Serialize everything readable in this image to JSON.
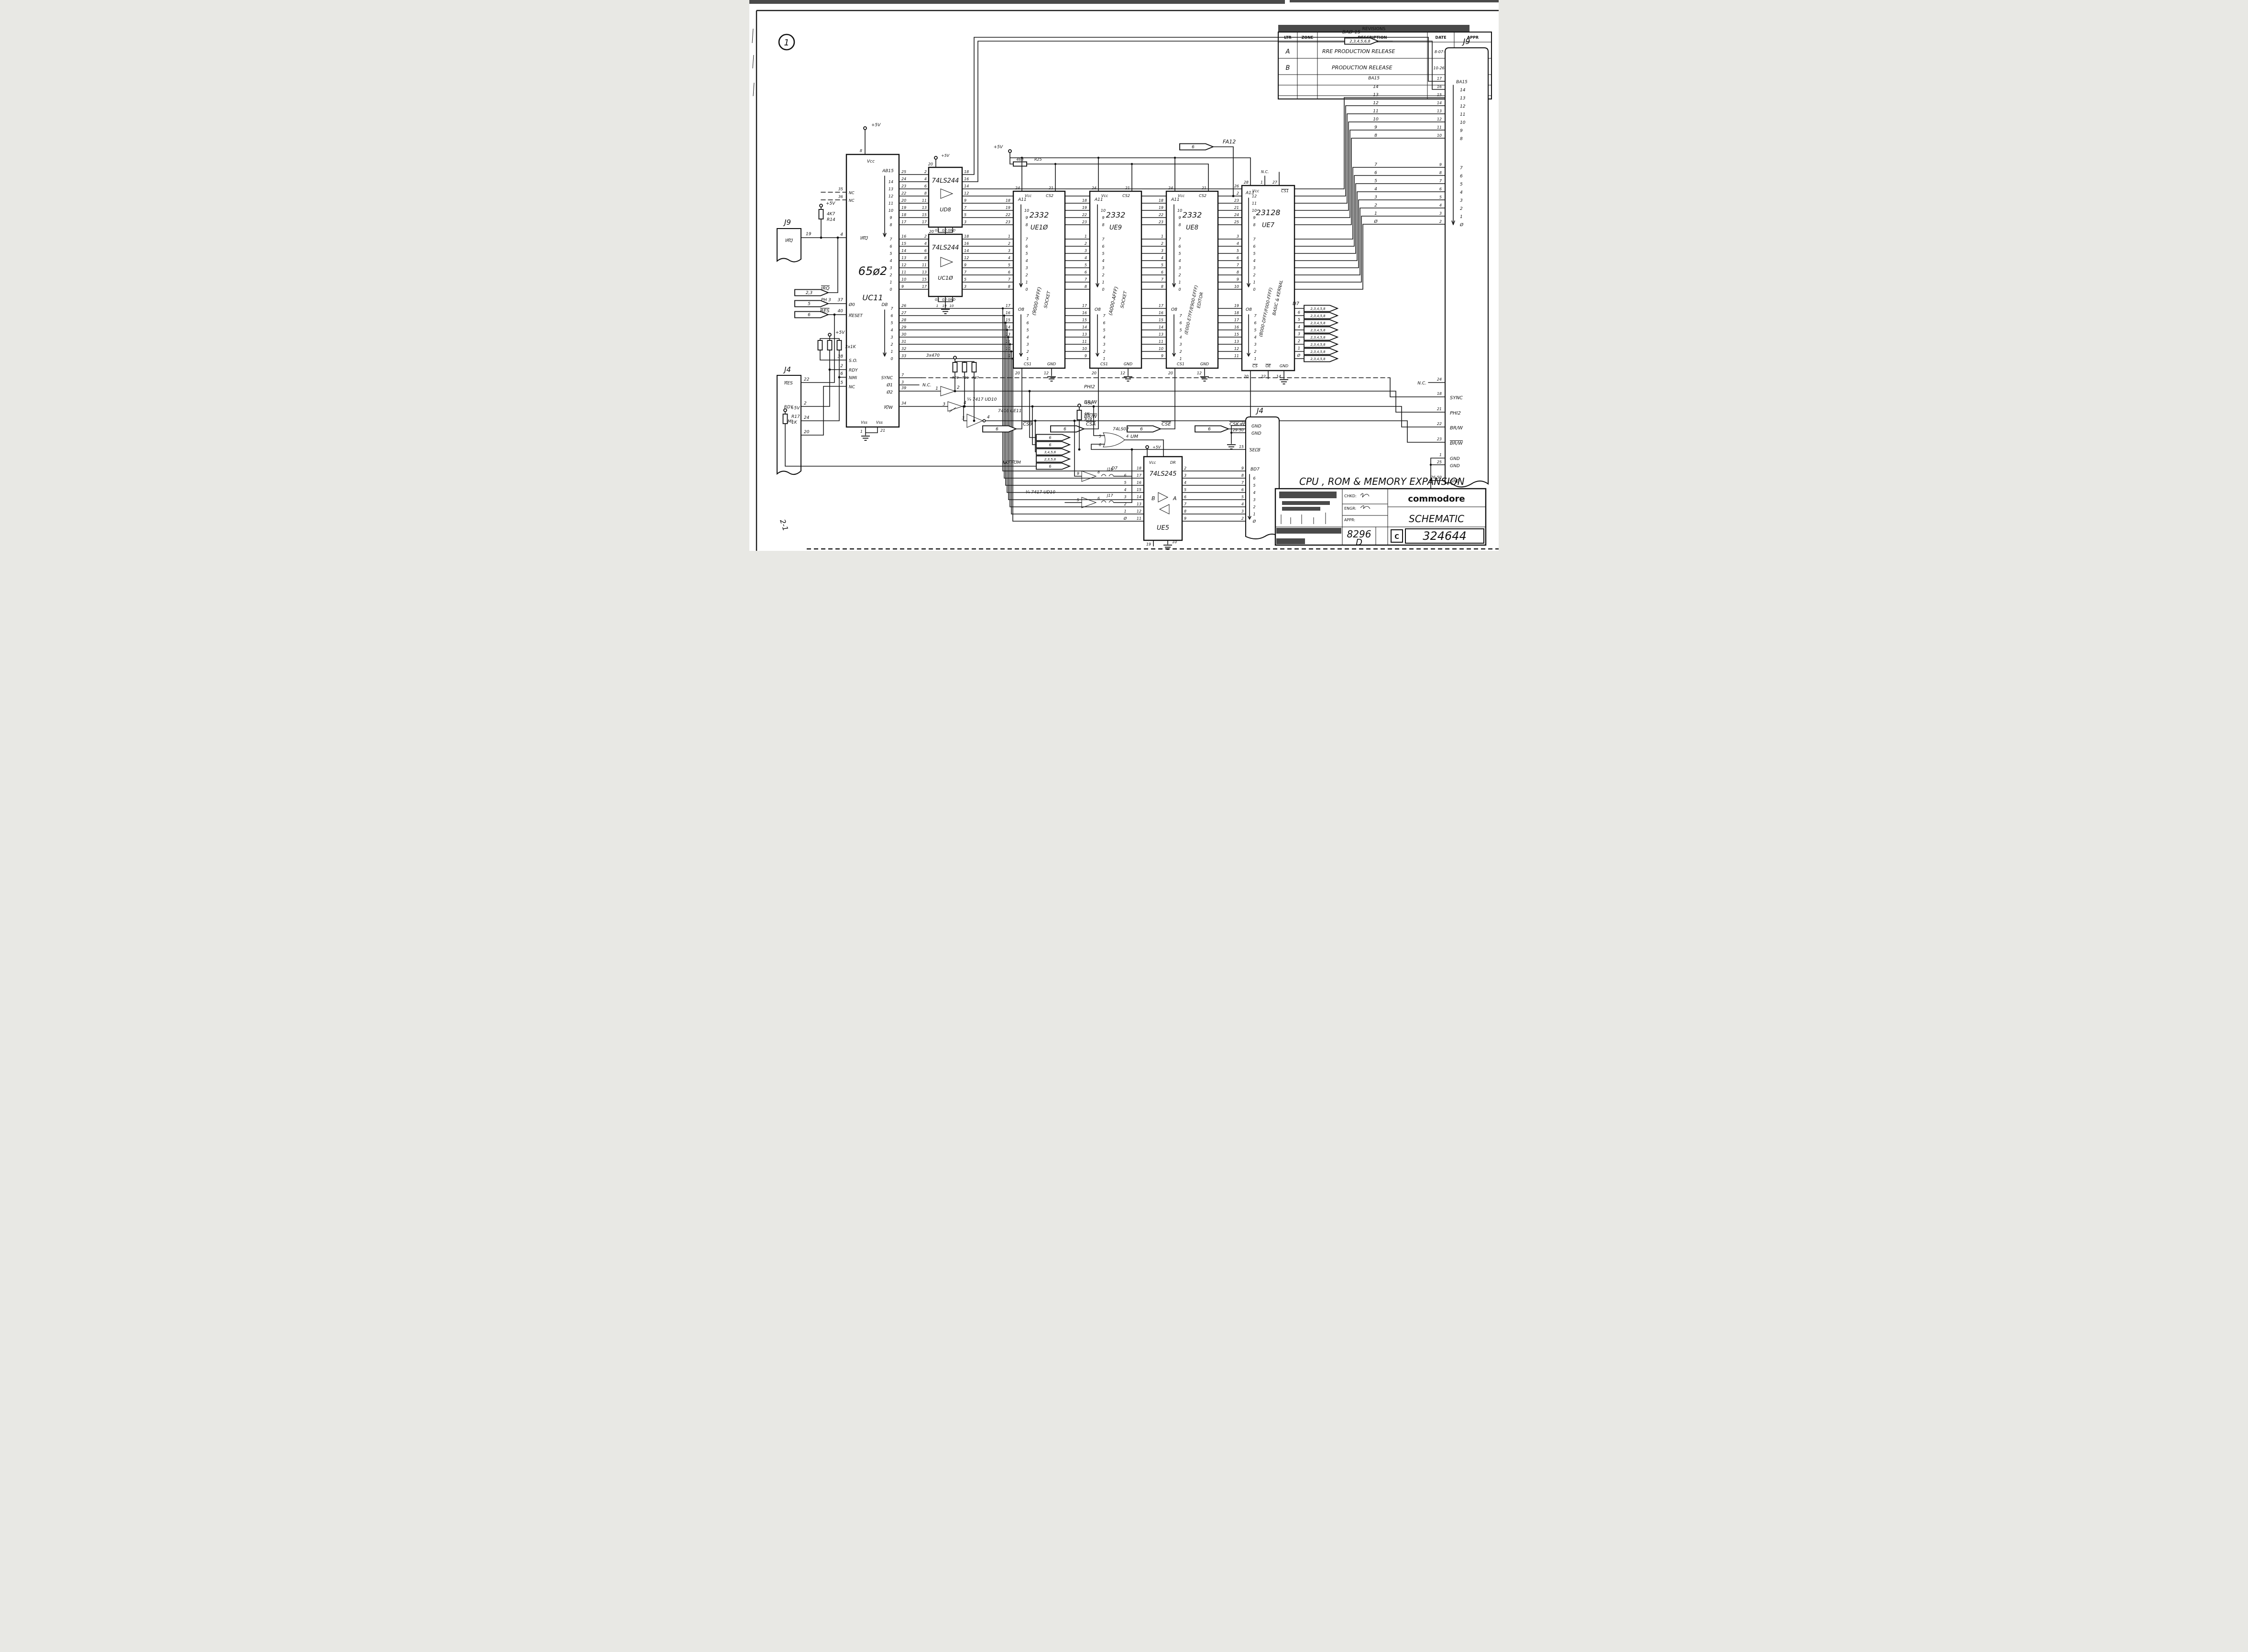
{
  "page": {
    "circle": "1",
    "side": "2-1"
  },
  "revisions": {
    "banner": "REVISIONS",
    "headers": [
      "LTR",
      "ZONE",
      "DESCRIPTION",
      "DATE",
      "APPR"
    ],
    "rows": [
      {
        "ltr": "A",
        "zone": "",
        "desc": "RRE PRODUCTION RELEASE",
        "date": "8-07-8",
        "appr": "SL"
      },
      {
        "ltr": "B",
        "zone": "",
        "desc": "PRODUCTION RELEASE",
        "date": "10-26-8",
        "appr": "SQ"
      }
    ]
  },
  "title_block": {
    "sheet_title": "CPU , ROM & MEMORY EXPANSION",
    "brand": "commodore",
    "doc": "SCHEMATIC",
    "chkd": "CHKD:",
    "engr": "ENGR:",
    "appr": "APPR:",
    "model": "8296",
    "size": "D",
    "class": "C",
    "number": "324644"
  },
  "power": {
    "v5": "+5V"
  },
  "cpu": {
    "part": "65ø2",
    "ref": "UC11",
    "vcc": "Vcc",
    "vcc_pin": "8",
    "nc_top_pins": [
      "35",
      "36"
    ],
    "nc": "NC",
    "irq": {
      "label": "IRQ",
      "pin": "4"
    },
    "phi0": {
      "label": "Ø0",
      "pin": "37"
    },
    "reset": {
      "label": "RESET",
      "pin": "40"
    },
    "so": {
      "label": "S.O.",
      "pin": "38"
    },
    "rdy": {
      "label": "RDY",
      "pin": "2"
    },
    "nmi": {
      "label": "NMI",
      "pin": "6"
    },
    "nc5": {
      "label": "NC",
      "pin": "5"
    },
    "vss": {
      "label": "Vss",
      "pin1": "1",
      "pin2": "21"
    },
    "ab_label": "AB15",
    "ab_hi_bits": [
      "14",
      "13",
      "12",
      "11",
      "10",
      "9",
      "8"
    ],
    "ab_hi_pins": [
      "25",
      "24",
      "23",
      "22",
      "20",
      "19",
      "18",
      "17"
    ],
    "ab_lo_bits": [
      "7",
      "6",
      "5",
      "4",
      "3",
      "2",
      "1",
      "0"
    ],
    "ab_lo_pins": [
      "16",
      "15",
      "14",
      "13",
      "12",
      "11",
      "10",
      "9"
    ],
    "db_label": "DB",
    "db_bits": [
      "7",
      "6",
      "5",
      "4",
      "3",
      "2",
      "1",
      "0"
    ],
    "db_pins": [
      "26",
      "27",
      "28",
      "29",
      "30",
      "31",
      "32",
      "33"
    ],
    "sync": {
      "label": "SYNC",
      "pin": "7"
    },
    "phi1": {
      "label": "Ø1",
      "pin": "3",
      "note": "N.C."
    },
    "phi2": {
      "label": "Ø2",
      "pin": "39"
    },
    "rw": {
      "label": "R/W",
      "pin": "34"
    }
  },
  "j9_left": {
    "ref": "J9",
    "net": "IRQ",
    "pin": "19"
  },
  "r14": {
    "value": "4K7",
    "ref": "R14"
  },
  "flags_left": [
    {
      "tag": "2,3",
      "net": "IRQ"
    },
    {
      "tag": "5",
      "net": "PH 3"
    },
    {
      "tag": "6",
      "net": "RES"
    }
  ],
  "j4_left": {
    "ref": "J4",
    "rows": [
      {
        "label": "RES",
        "pin": "22"
      },
      {
        "label": "RDY",
        "pin": "2"
      },
      {
        "label": "NMI",
        "pin": "24"
      },
      {
        "label": "",
        "pin": "20"
      }
    ]
  },
  "rp_1k": {
    "value": "3x1K"
  },
  "r17": {
    "ref": "R17",
    "value": "1K"
  },
  "buffers": {
    "ud8": {
      "part": "74LS244",
      "ref": "UD8",
      "vcc": "Vcc",
      "vcc_pin": "20",
      "in_pins": [
        "2",
        "4",
        "6",
        "8",
        "11",
        "13",
        "15",
        "17"
      ],
      "out_pins": [
        "18",
        "16",
        "14",
        "12",
        "9",
        "7",
        "5",
        "3"
      ],
      "g_labels": [
        "G1",
        "G2",
        "GND"
      ],
      "g_pins": [
        "1",
        "19",
        "10"
      ]
    },
    "uc10": {
      "part": "74LS244",
      "ref": "UC1Ø",
      "vcc": "Vcc",
      "vcc_pin": "20",
      "in_pins": [
        "2",
        "4",
        "6",
        "8",
        "11",
        "13",
        "15",
        "17"
      ],
      "out_pins": [
        "18",
        "16",
        "14",
        "12",
        "9",
        "7",
        "5",
        "3"
      ],
      "g_labels": [
        "G1",
        "G2",
        "GND"
      ],
      "g_pins": [
        "1",
        "19",
        "10"
      ]
    }
  },
  "r25": {
    "value": "468",
    "ref": "R25"
  },
  "rom_common": {
    "a_label": "A11",
    "a_hi_bits": [
      "10",
      "9",
      "8"
    ],
    "a_lo_bits": [
      "7",
      "6",
      "5",
      "4",
      "3",
      "2",
      "1",
      "0"
    ],
    "hi_pins": [
      "18",
      "19",
      "22",
      "23"
    ],
    "lo_pins": [
      "1",
      "2",
      "3",
      "4",
      "5",
      "6",
      "7",
      "8"
    ],
    "o_label": "O8",
    "o_bits": [
      "7",
      "6",
      "5",
      "4",
      "3",
      "2",
      "1"
    ],
    "out_pins": [
      "17",
      "16",
      "15",
      "14",
      "13",
      "11",
      "10",
      "9"
    ],
    "vcc": "Vcc",
    "vcc_pin": "24",
    "cs2": "CS2",
    "cs2_pin": "21",
    "cs1": "CS1",
    "cs1_pin": "20",
    "gnd": "GND",
    "gnd_pin": "12"
  },
  "roms": [
    {
      "part": "2332",
      "ref": "UE1Ø",
      "range": "(9000-9FFF)",
      "use": "SOCKET"
    },
    {
      "part": "2332",
      "ref": "UE9",
      "range": "(A000-AFFF)",
      "use": "SOCKET"
    },
    {
      "part": "2332",
      "ref": "UE8",
      "range": "(E000-E7FF/E900-EFFF)",
      "use": "EDITOR"
    }
  ],
  "ue7": {
    "part": "23128",
    "ref": "UE7",
    "range": "(B000-DFFF/F000-FFFF)",
    "use": "BASIC & KERNAL",
    "a_label": "A13",
    "hi_bits": [
      "12",
      "11",
      "10",
      "9",
      "8"
    ],
    "hi_pins": [
      "26",
      "2",
      "23",
      "21",
      "24",
      "25"
    ],
    "lo_bits": [
      "7",
      "6",
      "5",
      "4",
      "3",
      "2",
      "1",
      "0"
    ],
    "lo_pins": [
      "3",
      "4",
      "5",
      "6",
      "7",
      "8",
      "9",
      "10"
    ],
    "o_label": "O8",
    "o_bits": [
      "7",
      "6",
      "5",
      "4",
      "3",
      "2",
      "1"
    ],
    "out_pins": [
      "19",
      "18",
      "17",
      "16",
      "15",
      "13",
      "12",
      "11"
    ],
    "vcc": "Vcc",
    "vcc_pin": "28",
    "nc": "N.C.",
    "nc_pin": "1",
    "cs1": "CS1",
    "cs1_pin": "27",
    "cs": "CS",
    "cs_pin": "20",
    "oe": "OE",
    "oe_pin": "22",
    "gnd": "GND",
    "gnd_pin": "14"
  },
  "fa12": {
    "tag": "6",
    "net": "FA12"
  },
  "ba_flag": {
    "tag": "2,3,4,5,6,8",
    "net": "BAØ-15"
  },
  "cs_flags": [
    {
      "tag": "6",
      "net": "CS9"
    },
    {
      "tag": "6",
      "net": "CSA"
    },
    {
      "tag": "6",
      "net": "CSE"
    },
    {
      "tag": "6",
      "net": "CSK+B"
    }
  ],
  "misc_flags": {
    "tags": [
      "6",
      "6",
      "3,4,5,6",
      "2,3,5,6",
      "6"
    ],
    "no_rom": "NO ROM"
  },
  "gates": {
    "ud10a": {
      "label": "¼ 7417 UD10",
      "g1_in": "1",
      "g1_out": "2",
      "g2_in": "3",
      "g2_out": "4"
    },
    "ue11": {
      "label": "7406 UE11",
      "in": "3",
      "out": "4"
    },
    "ud10b": {
      "label": "¼ 7417 UD10",
      "g1_in": "9",
      "g1_out": "8",
      "g2_in": "5",
      "g2_out": "6",
      "j1": "J16",
      "j2": "J17"
    },
    "um": {
      "part": "74LS02",
      "ref": "UM",
      "in1": "5",
      "in2": "6",
      "out": "4"
    }
  },
  "r470": {
    "value": "3x470",
    "refs": [
      "R20",
      "R21",
      "R27"
    ]
  },
  "r24": {
    "value": "1K",
    "ref": "R24"
  },
  "nets": {
    "phi2": "PHI2",
    "brw": "BR/W",
    "brwn": "BR/W",
    "sync": "SYNC"
  },
  "d_bus": {
    "label": "D7",
    "bits": [
      "6",
      "5",
      "4",
      "3",
      "2",
      "1",
      "Ø"
    ],
    "flag_tag": "2,3,4,5,8"
  },
  "ue5": {
    "part": "74LS245",
    "ref": "UE5",
    "b": "B",
    "a": "A",
    "dr": "DR",
    "vcc": "Vcc",
    "left_label": "D7",
    "left_bits": [
      "6",
      "5",
      "4",
      "3",
      "2",
      "1",
      "Ø"
    ],
    "left_pins": [
      "18",
      "17",
      "16",
      "15",
      "14",
      "13",
      "12",
      "11"
    ],
    "right_pins": [
      "2",
      "3",
      "4",
      "5",
      "6",
      "7",
      "8",
      "9"
    ],
    "en_pin": "19",
    "gnd_pin": "10"
  },
  "j4_right": {
    "ref": "J4",
    "gnd1_pin": "1",
    "gnd1": "GND",
    "gnd2_pin": "29-50",
    "gnd2": "GND",
    "sel_pin": "15",
    "sel": "SELB",
    "bd_label": "BD7",
    "bd_bits": [
      "6",
      "5",
      "4",
      "3",
      "2",
      "1",
      "Ø"
    ],
    "bd_pins": [
      "9",
      "8",
      "7",
      "6",
      "5",
      "4",
      "3",
      "2"
    ]
  },
  "j9_right": {
    "ref": "J9",
    "ba_label": "BA15",
    "hi_bits": [
      "14",
      "13",
      "12",
      "11",
      "10",
      "9",
      "8"
    ],
    "hi_pins": [
      "17",
      "16",
      "15",
      "14",
      "13",
      "12",
      "11",
      "10"
    ],
    "lo_bits": [
      "7",
      "6",
      "5",
      "4",
      "3",
      "2",
      "1",
      "Ø"
    ],
    "lo_pins": [
      "9",
      "8",
      "7",
      "6",
      "5",
      "4",
      "3",
      "2"
    ],
    "inner_hi": [
      "BA15",
      "14",
      "13",
      "12",
      "11",
      "10",
      "9",
      "8"
    ],
    "inner_lo": [
      "7",
      "6",
      "5",
      "4",
      "3",
      "2",
      "1",
      "Ø"
    ],
    "nc": {
      "pin": "24",
      "label": "N.C."
    },
    "signals": [
      {
        "pin": "18",
        "label": "SYNC"
      },
      {
        "pin": "21",
        "label": "PHI2"
      },
      {
        "pin": "22",
        "label": "BR/W"
      },
      {
        "pin": "23",
        "label": "BR/W"
      },
      {
        "pin": "1",
        "label": "GND"
      },
      {
        "pin": "25",
        "label": "GND"
      },
      {
        "pin": "26-50",
        "label": "GND"
      }
    ]
  }
}
